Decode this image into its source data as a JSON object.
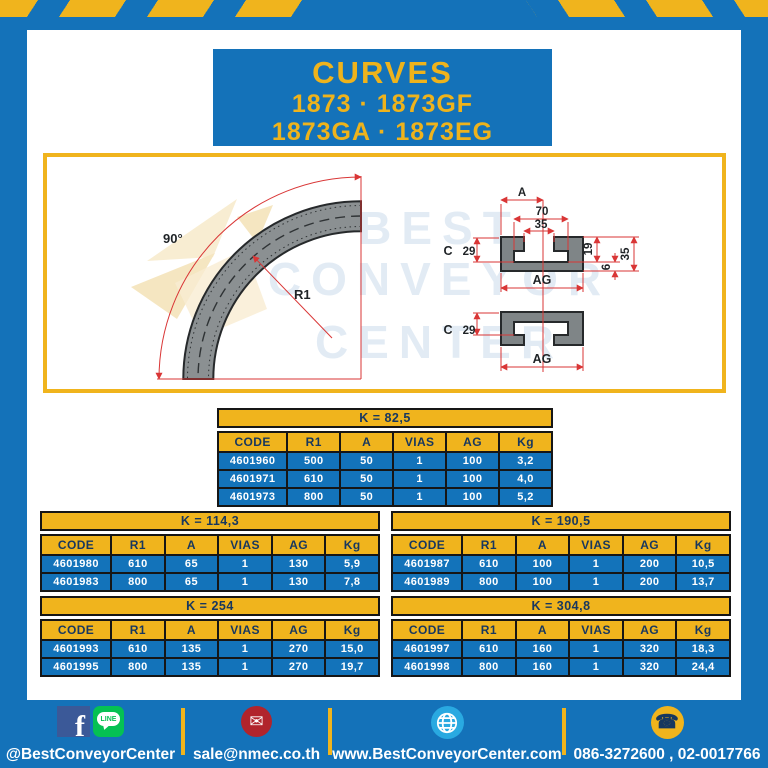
{
  "header": {
    "title": "CURVES",
    "subtitle1": "1873 · 1873GF",
    "subtitle2": "1873GA · 1873EG"
  },
  "watermark": {
    "line1": "BEST",
    "line2": "CONVEYOR",
    "line3": "CENTER"
  },
  "drawing": {
    "labels": {
      "angle": "90°",
      "radius": "R1",
      "a": "A",
      "w70": "70",
      "w35": "35",
      "c": "C",
      "h29": "29",
      "h19": "19",
      "h6": "6",
      "h35": "35",
      "ag": "AG"
    }
  },
  "columns": [
    "CODE",
    "R1",
    "A",
    "VIAS",
    "AG",
    "Kg"
  ],
  "tables": [
    {
      "title": "K = 82,5",
      "rows": [
        [
          "4601960",
          "500",
          "50",
          "1",
          "100",
          "3,2"
        ],
        [
          "4601971",
          "610",
          "50",
          "1",
          "100",
          "4,0"
        ],
        [
          "4601973",
          "800",
          "50",
          "1",
          "100",
          "5,2"
        ]
      ]
    },
    {
      "title": "K = 114,3",
      "rows": [
        [
          "4601980",
          "610",
          "65",
          "1",
          "130",
          "5,9"
        ],
        [
          "4601983",
          "800",
          "65",
          "1",
          "130",
          "7,8"
        ]
      ]
    },
    {
      "title": "K = 190,5",
      "rows": [
        [
          "4601987",
          "610",
          "100",
          "1",
          "200",
          "10,5"
        ],
        [
          "4601989",
          "800",
          "100",
          "1",
          "200",
          "13,7"
        ]
      ]
    },
    {
      "title": "K = 254",
      "rows": [
        [
          "4601993",
          "610",
          "135",
          "1",
          "270",
          "15,0"
        ],
        [
          "4601995",
          "800",
          "135",
          "1",
          "270",
          "19,7"
        ]
      ]
    },
    {
      "title": "K = 304,8",
      "rows": [
        [
          "4601997",
          "610",
          "160",
          "1",
          "320",
          "18,3"
        ],
        [
          "4601998",
          "800",
          "160",
          "1",
          "320",
          "24,4"
        ]
      ]
    }
  ],
  "footer": {
    "social_label": "@BestConveyorCenter",
    "facebook_letter": "f",
    "line_text": "LINE",
    "email_glyph": "✉",
    "email": "sale@nmec.co.th",
    "website": "www.BestConveyorCenter.com",
    "phone_glyph": "☎",
    "phones": "086-3272600 , 02-0017766"
  },
  "colors": {
    "blue": "#1472b9",
    "cell_blue": "#1373ba",
    "yellow": "#f0b41d",
    "navy": "#17375f",
    "dim_red": "#d93636"
  }
}
